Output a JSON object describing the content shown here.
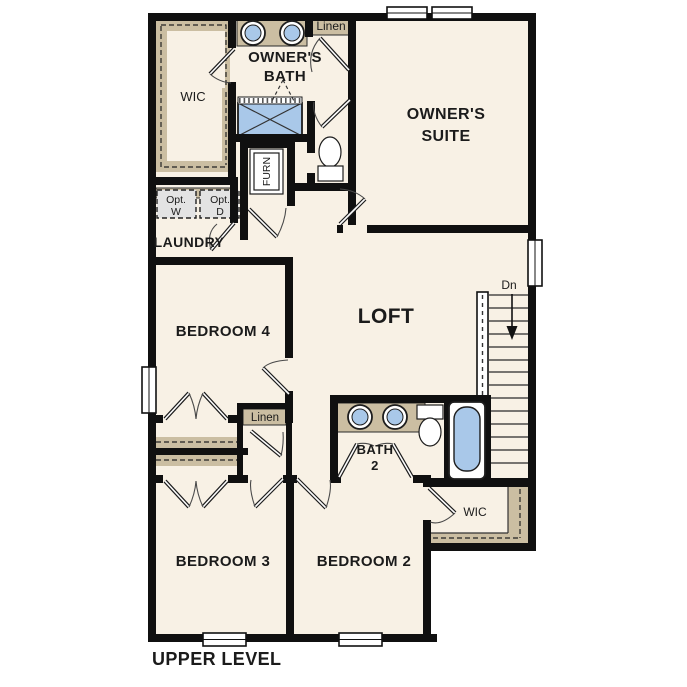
{
  "plan": {
    "title": "UPPER LEVEL",
    "rooms": {
      "wic_upper": "WIC",
      "owners_bath_line1": "OWNER'S",
      "owners_bath_line2": "BATH",
      "linen_upper": "Linen",
      "owners_suite_line1": "OWNER'S",
      "owners_suite_line2": "SUITE",
      "furnace": "FURN",
      "opt_washer_line1": "Opt.",
      "opt_washer_line2": "W",
      "opt_dryer_line1": "Opt.",
      "opt_dryer_line2": "D",
      "laundry": "LAUNDRY",
      "bedroom4": "BEDROOM 4",
      "loft": "LOFT",
      "stairs_direction": "Dn",
      "linen_mid": "Linen",
      "bath2_line1": "BATH",
      "bath2_line2": "2",
      "wic_lower": "WIC",
      "bedroom3": "BEDROOM 3",
      "bedroom2": "BEDROOM 2"
    },
    "colors": {
      "floor": "#f8f1e5",
      "wall": "#101010",
      "casework": "#cbbea2",
      "fixture_blue": "#a9c8e9",
      "appliance_gray": "#e3e3e3",
      "background": "#ffffff"
    }
  }
}
